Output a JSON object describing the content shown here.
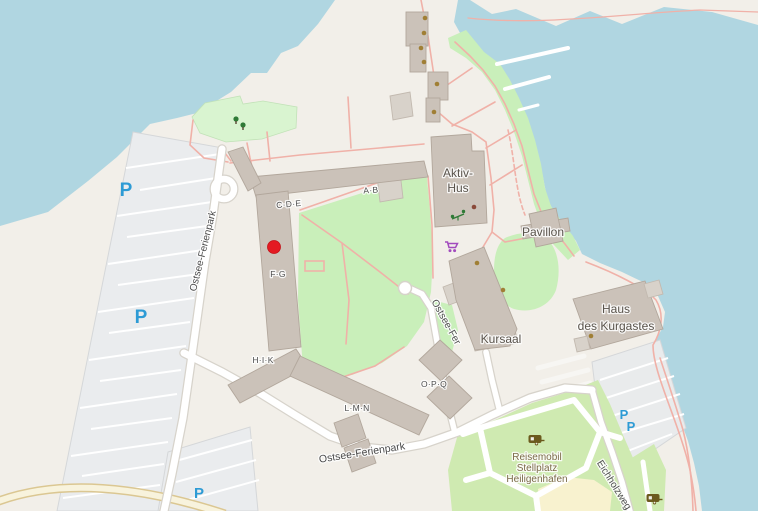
{
  "map": {
    "type": "openstreetmap-view",
    "roads": {
      "ostsee_ferienpark": {
        "name": "Ostsee-Ferienpark"
      },
      "ostsee_fer": {
        "name": "Ostsee-Fer"
      },
      "eichholzweg": {
        "name": "Eichholzweg"
      }
    },
    "buildings": {
      "units": {
        "ab": "A·B",
        "cde": "C·D·E",
        "fg": "F·G",
        "hik": "H·I·K",
        "lmn": "L·M·N",
        "opq": "O·P·Q"
      },
      "aktiv_hus": {
        "line1": "Aktiv-",
        "line2": "Hus"
      },
      "pavillon": {
        "name": "Pavillon"
      },
      "kursaal": {
        "name": "Kursaal"
      },
      "haus_des_kurgastes": {
        "line1": "Haus",
        "line2": "des Kurgastes"
      }
    },
    "campsite": {
      "line1": "Reisemobil",
      "line2": "Stellplatz",
      "line3": "Heiligenhafen"
    },
    "parking": {
      "symbol": "P"
    },
    "icons": {
      "marker": "red-circle-marker",
      "supermarket": "shopping-cart-icon",
      "campsite": "caravan-icon",
      "playground": "playground-icon",
      "trees": "tree-icon",
      "poi": "brown-dot"
    },
    "colors": {
      "water": "#b0d6e1",
      "land": "#f2efe9",
      "parking_fill": "#eaecee",
      "grass": "#c9efba",
      "meadow": "#d9f4d0",
      "camp_green": "#cfeab1",
      "sand": "#f8f2cf",
      "building": "#cbc2b9",
      "building_stroke": "#b2a79c",
      "building_light": "#d8d2ca",
      "road_fill": "#ffffff",
      "road_casing": "#d7d3cb",
      "path_pink": "#f0b1a8",
      "parking_blue": "#2d9bd5",
      "marker_red": "#e41a22",
      "poi_brown": "#a07f35",
      "icon_purple": "#a24bbe",
      "icon_green": "#2f7a36",
      "icon_caravan": "#6b5a1d",
      "label_dark": "#4e4e4e",
      "label_building": "#59534b",
      "label_camp": "#7b6a48"
    }
  }
}
